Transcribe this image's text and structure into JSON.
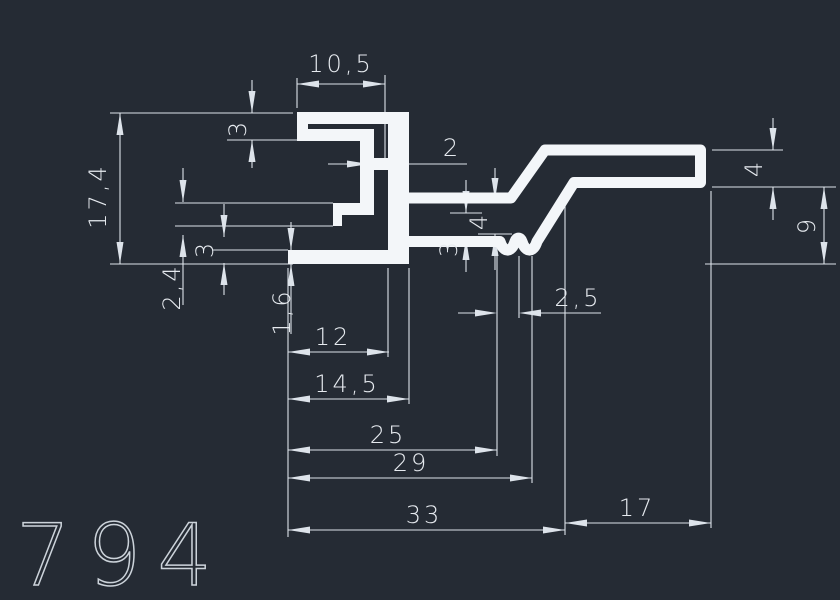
{
  "app": "cad-viewer",
  "part_number": "794",
  "canvas": {
    "width": 840,
    "height": 600,
    "background": "#252b34",
    "profile_color": "#f3f6f9",
    "dim_color": "#dde3ea",
    "text_color": "#e6eaef",
    "part_number_color": "#ccd3da"
  },
  "profile": {
    "rects": [
      [
        297,
        112,
        112,
        12
      ],
      [
        297,
        112,
        11,
        29
      ],
      [
        297,
        129,
        77,
        12
      ],
      [
        360,
        129,
        14,
        80
      ],
      [
        333,
        203,
        41,
        12
      ],
      [
        333,
        215,
        9,
        11
      ],
      [
        374,
        158,
        14,
        12
      ],
      [
        388,
        112,
        21,
        141
      ],
      [
        288,
        250,
        121,
        14
      ]
    ],
    "tube_path": "M403,198 H511 L545,150 H700.5 V182.5 H574 L537,241.5 C533.5,253 525.5,253 522,241.5 C520.5,237 516.5,237 515,241.5 C511.5,253 503.5,253 500,241.5 H403",
    "tube_stroke": 11
  },
  "dims": {
    "ext_h": [
      [
        110,
        293,
        113
      ],
      [
        227,
        297,
        140
      ],
      [
        175,
        333,
        203
      ],
      [
        175,
        333,
        226
      ],
      [
        213,
        288,
        250
      ],
      [
        110,
        293,
        264
      ],
      [
        705,
        836,
        264
      ],
      [
        712,
        783,
        150
      ],
      [
        712,
        836,
        187
      ],
      [
        478,
        512,
        200
      ],
      [
        478,
        512,
        234
      ],
      [
        450,
        482,
        213
      ],
      [
        450,
        490,
        238
      ]
    ],
    "ext_v": [
      [
        268,
        537,
        288
      ],
      [
        78,
        108,
        297
      ],
      [
        75,
        160,
        385
      ],
      [
        150,
        212,
        371
      ],
      [
        268,
        357,
        388
      ],
      [
        268,
        404,
        409
      ],
      [
        256,
        456,
        497
      ],
      [
        256,
        318,
        519
      ],
      [
        256,
        483,
        532
      ],
      [
        191,
        535,
        565
      ],
      [
        191,
        528,
        711
      ]
    ],
    "lines": [
      [
        297,
        84,
        385,
        84
      ],
      [
        288,
        352,
        389,
        352
      ],
      [
        288,
        399,
        409,
        399
      ],
      [
        288,
        450,
        497,
        450
      ],
      [
        288,
        478,
        532,
        478
      ],
      [
        288,
        530,
        565,
        530
      ],
      [
        565,
        523,
        711,
        523
      ],
      [
        120,
        113,
        120,
        264
      ],
      [
        824,
        187,
        824,
        264
      ],
      [
        328,
        164,
        352,
        164
      ],
      [
        404,
        164,
        467,
        164
      ],
      [
        458,
        313,
        480,
        313
      ],
      [
        536,
        313,
        601,
        313
      ],
      [
        252,
        80,
        252,
        113
      ],
      [
        252,
        140,
        252,
        168
      ],
      [
        183,
        168,
        183,
        202
      ],
      [
        183,
        235,
        183,
        305
      ],
      [
        224,
        204,
        224,
        237
      ],
      [
        224,
        263,
        224,
        295
      ],
      [
        291,
        222,
        291,
        250
      ],
      [
        291,
        264,
        291,
        334
      ],
      [
        495,
        168,
        495,
        200
      ],
      [
        495,
        234,
        495,
        270
      ],
      [
        466,
        180,
        466,
        213
      ],
      [
        466,
        238,
        466,
        272
      ],
      [
        773,
        118,
        773,
        150
      ],
      [
        773,
        187,
        773,
        220
      ]
    ],
    "arrows": [
      [
        297,
        84,
        "l"
      ],
      [
        385,
        84,
        "r"
      ],
      [
        288,
        352,
        "l"
      ],
      [
        389,
        352,
        "r"
      ],
      [
        288,
        399,
        "l"
      ],
      [
        409,
        399,
        "r"
      ],
      [
        288,
        450,
        "l"
      ],
      [
        497,
        450,
        "r"
      ],
      [
        288,
        478,
        "l"
      ],
      [
        532,
        478,
        "r"
      ],
      [
        288,
        530,
        "l"
      ],
      [
        565,
        530,
        "r"
      ],
      [
        565,
        523,
        "l"
      ],
      [
        711,
        523,
        "r"
      ],
      [
        120,
        113,
        "u"
      ],
      [
        120,
        264,
        "d"
      ],
      [
        824,
        187,
        "u"
      ],
      [
        824,
        264,
        "d"
      ],
      [
        369,
        164,
        "r"
      ],
      [
        386,
        164,
        "l"
      ],
      [
        497,
        313,
        "r"
      ],
      [
        519,
        313,
        "l"
      ],
      [
        252,
        113,
        "d"
      ],
      [
        252,
        140,
        "u"
      ],
      [
        183,
        202,
        "d"
      ],
      [
        183,
        235,
        "u"
      ],
      [
        224,
        237,
        "d"
      ],
      [
        224,
        263,
        "u"
      ],
      [
        291,
        250,
        "d"
      ],
      [
        291,
        264,
        "u"
      ],
      [
        495,
        200,
        "d"
      ],
      [
        495,
        234,
        "u"
      ],
      [
        466,
        213,
        "d"
      ],
      [
        466,
        238,
        "u"
      ],
      [
        773,
        150,
        "d"
      ],
      [
        773,
        187,
        "u"
      ]
    ],
    "labels": [
      {
        "id": "dim-10-5",
        "t": "10,5",
        "x": 341,
        "y": 72,
        "r": 0
      },
      {
        "id": "dim-12",
        "t": "12",
        "x": 333,
        "y": 345,
        "r": 0
      },
      {
        "id": "dim-14-5",
        "t": "14,5",
        "x": 347,
        "y": 392,
        "r": 0
      },
      {
        "id": "dim-25",
        "t": "25",
        "x": 388,
        "y": 443,
        "r": 0
      },
      {
        "id": "dim-29",
        "t": "29",
        "x": 411,
        "y": 471,
        "r": 0
      },
      {
        "id": "dim-33",
        "t": "33",
        "x": 424,
        "y": 523,
        "r": 0
      },
      {
        "id": "dim-17",
        "t": "17",
        "x": 637,
        "y": 516,
        "r": 0
      },
      {
        "id": "dim-2",
        "t": "2",
        "x": 452,
        "y": 156,
        "r": 0
      },
      {
        "id": "dim-2-5",
        "t": "2,5",
        "x": 578,
        "y": 306,
        "r": 0
      },
      {
        "id": "dim-17-4",
        "t": "17,4",
        "x": 98,
        "y": 196,
        "r": -90
      },
      {
        "id": "dim-3-top",
        "t": "3",
        "x": 238,
        "y": 128,
        "r": -90
      },
      {
        "id": "dim-2-4",
        "t": "2,4",
        "x": 172,
        "y": 287,
        "r": -90
      },
      {
        "id": "dim-3-left",
        "t": "3",
        "x": 205,
        "y": 249,
        "r": -90
      },
      {
        "id": "dim-1-6",
        "t": "1,6",
        "x": 282,
        "y": 312,
        "r": -90
      },
      {
        "id": "dim-4-mid",
        "t": "4",
        "x": 479,
        "y": 221,
        "r": -90
      },
      {
        "id": "dim-3-mid",
        "t": "3",
        "x": 449,
        "y": 248,
        "r": -90
      },
      {
        "id": "dim-4-right",
        "t": "4",
        "x": 754,
        "y": 168,
        "r": -90
      },
      {
        "id": "dim-9",
        "t": "9",
        "x": 807,
        "y": 225,
        "r": -90
      }
    ]
  },
  "part_label": {
    "x": 16,
    "y": 585,
    "font_size": 86,
    "letter_spacing": 16
  }
}
